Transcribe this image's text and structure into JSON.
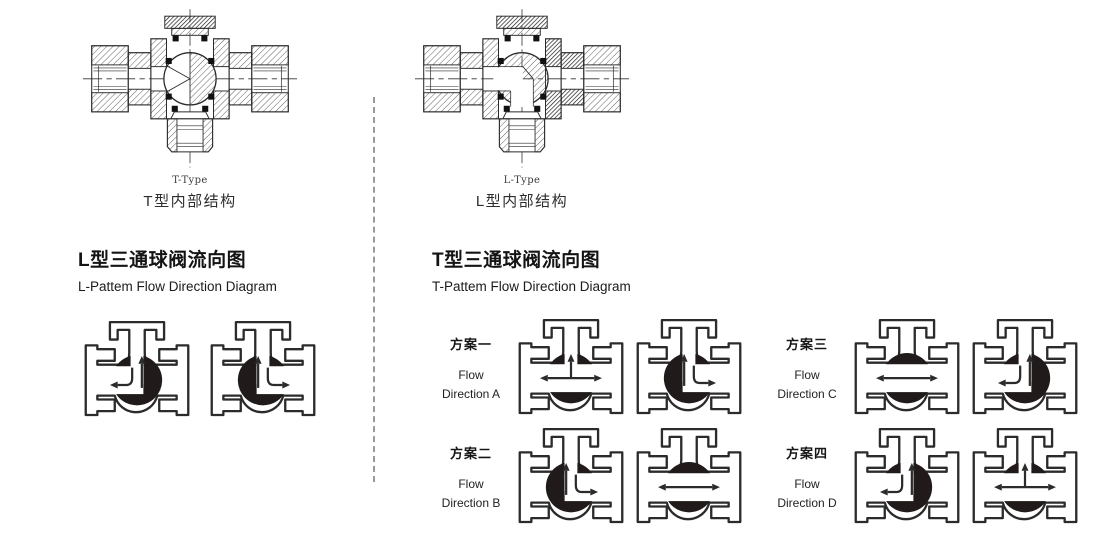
{
  "page": {
    "background": "#ffffff",
    "line_color": "#2b2b2b",
    "ball_color": "#201b1a",
    "divider_color": "#9a9a9a"
  },
  "structures": [
    {
      "id": "t",
      "type_label": "T-Type",
      "caption": "T型内部结构"
    },
    {
      "id": "l",
      "type_label": "L-Type",
      "caption": "L型内部结构"
    }
  ],
  "l_section": {
    "title": "L型三通球阀流向图",
    "subtitle": "L-Pattem Flow Direction Diagram",
    "valves": [
      "up-left",
      "up-right"
    ]
  },
  "t_section": {
    "title": "T型三通球阀流向图",
    "subtitle": "T-Pattem Flow Direction Diagram",
    "schemes": [
      {
        "name": "方案一",
        "en_line1": "Flow",
        "en_line2": "Direction A",
        "valves": [
          "tee-up",
          "up-right"
        ]
      },
      {
        "name": "方案三",
        "en_line1": "Flow",
        "en_line2": "Direction C",
        "valves": [
          "through",
          "up-left"
        ]
      },
      {
        "name": "方案二",
        "en_line1": "Flow",
        "en_line2": "Direction B",
        "valves": [
          "up-right",
          "through"
        ]
      },
      {
        "name": "方案四",
        "en_line1": "Flow",
        "en_line2": "Direction D",
        "valves": [
          "up-left",
          "tee-up"
        ]
      }
    ]
  }
}
